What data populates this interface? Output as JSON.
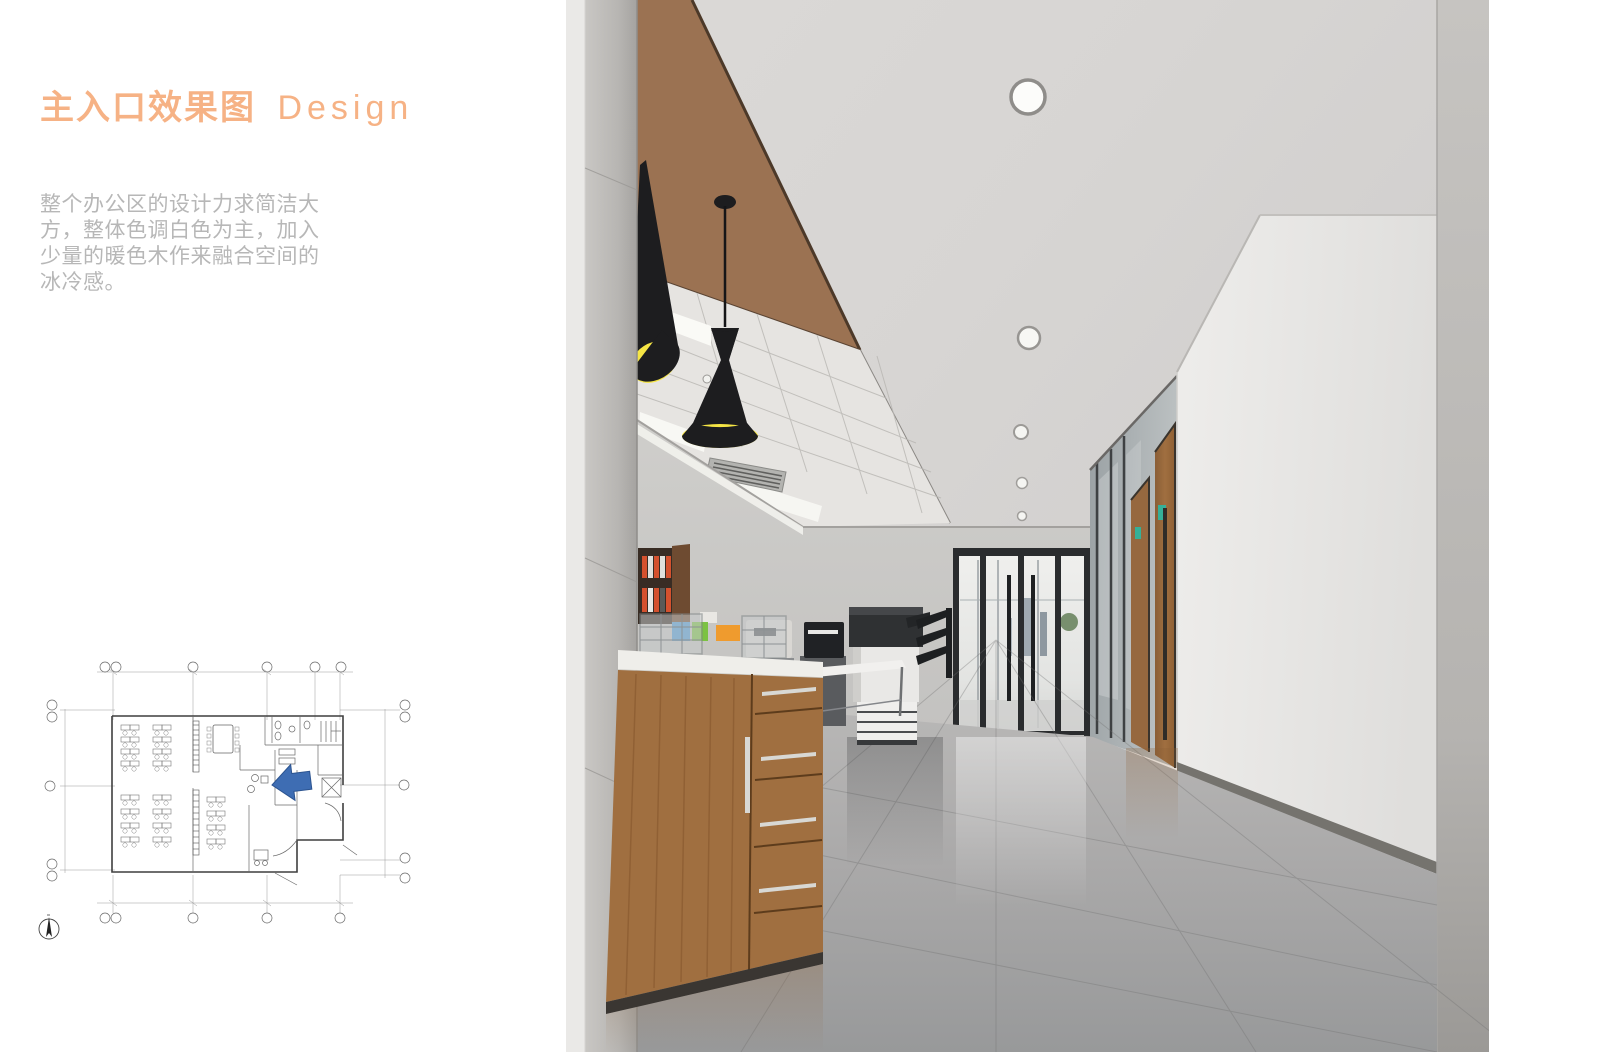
{
  "page": {
    "background": "#ffffff"
  },
  "title": {
    "zh": "主入口效果图",
    "en": "Design",
    "color": "#f6b285"
  },
  "description": {
    "text": "整个办公区的设计力求简洁大\n方，整体色调白色为主，加入\n少量的暖色木作来融合空间的\n冰冷感。",
    "color": "#b7b7b7"
  },
  "floor_plan": {
    "label": "first-floor-plan-thumbnail",
    "entrance_arrow_color": "#3e6db3",
    "line_color": "#555555"
  },
  "rendering": {
    "label": "main-entrance-interior-rendering",
    "palette": {
      "ceiling": "#d7d5d3",
      "bronze_panel": "#9b7252",
      "tile_ceiling": "#e6e4e1",
      "wall": "#c9c8c6",
      "pillar": "#e8e7e5",
      "wood_cabinet": "#a06f40",
      "wood_door": "#96683f",
      "lamp_black": "#1d1d1f",
      "lamp_yellow": "#f5e545",
      "floor": "#a8a8a8",
      "exit_sign": "#35b098",
      "door_frame": "#2a2c2e",
      "binder_orange": "#d4512e",
      "box_blue": "#4f9bd5",
      "box_green": "#7cc242",
      "box_orange": "#ef9b2e"
    }
  }
}
